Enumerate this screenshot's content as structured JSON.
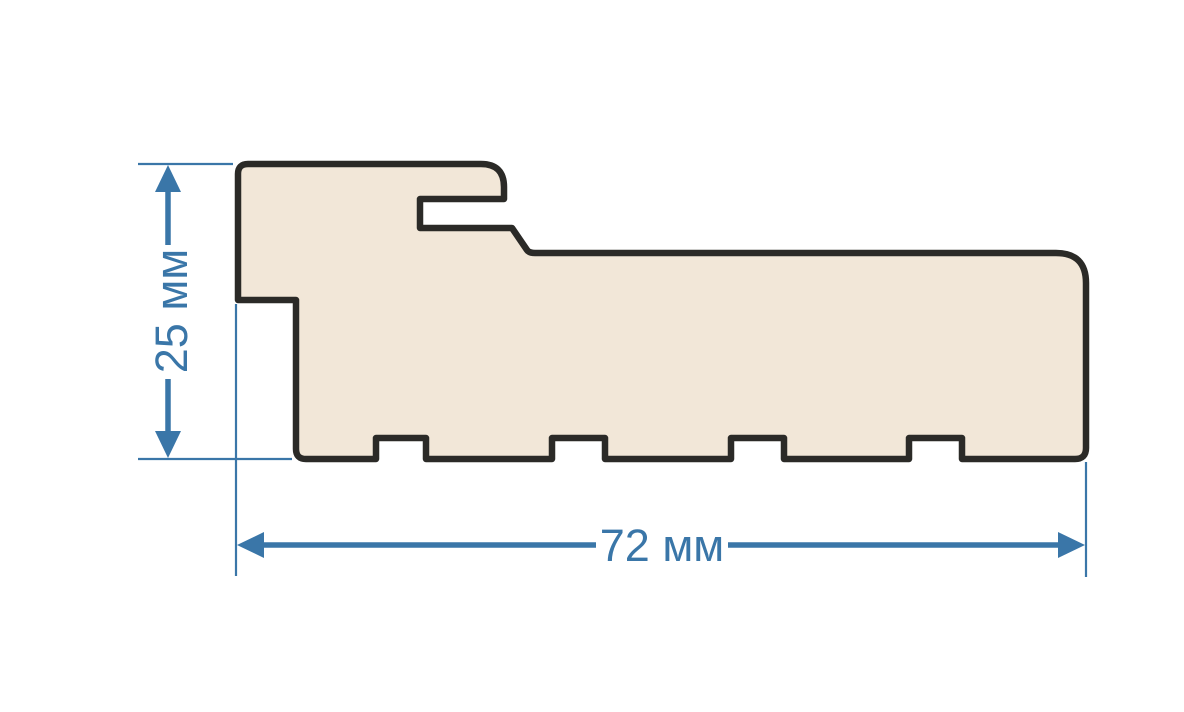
{
  "drawing": {
    "type": "profile-cross-section-drawing",
    "background_color": "#ffffff",
    "profile": {
      "name": "door-frame-profile",
      "fill_color": "#f2e7d8",
      "outline_color": "#2b2a27"
    },
    "dimension_style": {
      "color": "#3a76a8"
    },
    "dimensions": {
      "height": {
        "label": "25 мм",
        "value": 25,
        "unit": "мм"
      },
      "width": {
        "label": "72 мм",
        "value": 72,
        "unit": "мм"
      }
    }
  }
}
